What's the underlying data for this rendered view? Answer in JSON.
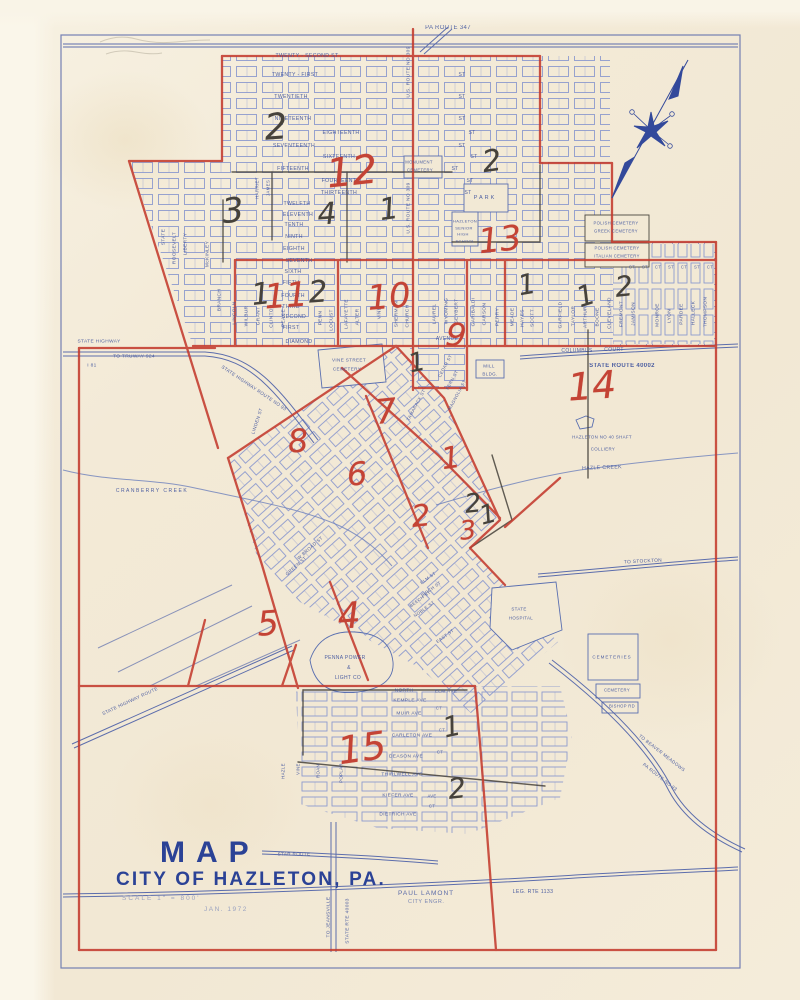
{
  "title_block": {
    "line1": "MAP",
    "line2": "CITY OF HAZLETON, PA.",
    "scale": "SCALE  1\" = 800'",
    "engineer": "PAUL LAMONT",
    "engineer_title": "CITY ENGR.",
    "date": "JAN. 1972"
  },
  "colors": {
    "paper": "#f2e9d5",
    "ink_blue": "#4c60a8",
    "block_blue": "#8d9ace",
    "ink_red": "#c43b2e",
    "pencil_black": "#46423b"
  },
  "ward_numbers": [
    {
      "t": "2",
      "c": "black",
      "x": 276,
      "y": 128,
      "s": 36,
      "r": -4
    },
    {
      "t": "12",
      "c": "red",
      "x": 352,
      "y": 172,
      "s": 40,
      "r": -6
    },
    {
      "t": "2",
      "c": "black",
      "x": 492,
      "y": 162,
      "s": 30,
      "r": -8
    },
    {
      "t": "3",
      "c": "black",
      "x": 233,
      "y": 211,
      "s": 34,
      "r": -6
    },
    {
      "t": "4",
      "c": "black",
      "x": 327,
      "y": 215,
      "s": 30,
      "r": -4
    },
    {
      "t": "1",
      "c": "black",
      "x": 389,
      "y": 210,
      "s": 30,
      "r": -8
    },
    {
      "t": "13",
      "c": "red",
      "x": 500,
      "y": 240,
      "s": 34,
      "r": -6
    },
    {
      "t": "1",
      "c": "black",
      "x": 261,
      "y": 295,
      "s": 30,
      "r": -6
    },
    {
      "t": "11",
      "c": "red",
      "x": 286,
      "y": 296,
      "s": 34,
      "r": -4
    },
    {
      "t": "2",
      "c": "black",
      "x": 318,
      "y": 293,
      "s": 30,
      "r": -4
    },
    {
      "t": "10",
      "c": "red",
      "x": 389,
      "y": 297,
      "s": 34,
      "r": -5
    },
    {
      "t": "1",
      "c": "black",
      "x": 527,
      "y": 285,
      "s": 28,
      "r": -10
    },
    {
      "t": "1",
      "c": "black",
      "x": 586,
      "y": 296,
      "s": 28,
      "r": -18
    },
    {
      "t": "2",
      "c": "black",
      "x": 624,
      "y": 287,
      "s": 28,
      "r": -6
    },
    {
      "t": "9",
      "c": "red",
      "x": 456,
      "y": 335,
      "s": 32,
      "r": 6
    },
    {
      "t": "1",
      "c": "black",
      "x": 417,
      "y": 363,
      "s": 26,
      "r": -12
    },
    {
      "t": "14",
      "c": "red",
      "x": 592,
      "y": 386,
      "s": 38,
      "r": -4
    },
    {
      "t": "7",
      "c": "red",
      "x": 386,
      "y": 412,
      "s": 34,
      "r": -6
    },
    {
      "t": "8",
      "c": "red",
      "x": 298,
      "y": 441,
      "s": 32,
      "r": -4
    },
    {
      "t": "1",
      "c": "red",
      "x": 451,
      "y": 459,
      "s": 30,
      "r": -8
    },
    {
      "t": "6",
      "c": "red",
      "x": 357,
      "y": 474,
      "s": 32,
      "r": -4
    },
    {
      "t": "2",
      "c": "black",
      "x": 473,
      "y": 504,
      "s": 26,
      "r": -6
    },
    {
      "t": "1",
      "c": "black",
      "x": 488,
      "y": 515,
      "s": 26,
      "r": -15
    },
    {
      "t": "2",
      "c": "red",
      "x": 421,
      "y": 517,
      "s": 30,
      "r": -6
    },
    {
      "t": "3",
      "c": "red",
      "x": 468,
      "y": 531,
      "s": 26,
      "r": -6
    },
    {
      "t": "5",
      "c": "red",
      "x": 268,
      "y": 624,
      "s": 34,
      "r": -4
    },
    {
      "t": "4",
      "c": "red",
      "x": 349,
      "y": 617,
      "s": 36,
      "r": -4
    },
    {
      "t": "15",
      "c": "red",
      "x": 362,
      "y": 748,
      "s": 38,
      "r": -8
    },
    {
      "t": "1",
      "c": "black",
      "x": 452,
      "y": 727,
      "s": 28,
      "r": -12
    },
    {
      "t": "2",
      "c": "black",
      "x": 457,
      "y": 789,
      "s": 28,
      "r": -6
    }
  ],
  "map_labels": [
    {
      "t": "PA ROUTE 347",
      "x": 448,
      "y": 28,
      "s": 6
    },
    {
      "t": "U.S. ROUTE NO 309",
      "x": 409,
      "y": 72,
      "s": 4.8,
      "r": -90
    },
    {
      "t": "U.S. ROUTE NO 309",
      "x": 409,
      "y": 208,
      "s": 4.8,
      "r": -90
    },
    {
      "t": "TWENTY - SECOND ST",
      "x": 307,
      "y": 56,
      "s": 5.2
    },
    {
      "t": "TWENTY - FIRST",
      "x": 295,
      "y": 75,
      "s": 5.2
    },
    {
      "t": "ST",
      "x": 462,
      "y": 75,
      "s": 5
    },
    {
      "t": "TWENTIETH",
      "x": 291,
      "y": 97,
      "s": 5.2
    },
    {
      "t": "ST",
      "x": 462,
      "y": 97,
      "s": 5
    },
    {
      "t": "NINETEENTH",
      "x": 293,
      "y": 119,
      "s": 5.2
    },
    {
      "t": "ST",
      "x": 462,
      "y": 119,
      "s": 5
    },
    {
      "t": "EIGHTEENTH",
      "x": 341,
      "y": 133,
      "s": 5.2
    },
    {
      "t": "ST",
      "x": 472,
      "y": 133,
      "s": 5
    },
    {
      "t": "SEVENTEENTH",
      "x": 294,
      "y": 146,
      "s": 5.2
    },
    {
      "t": "ST",
      "x": 462,
      "y": 146,
      "s": 5
    },
    {
      "t": "SIXTEENTH",
      "x": 339,
      "y": 157,
      "s": 5.2
    },
    {
      "t": "ST",
      "x": 474,
      "y": 157,
      "s": 5
    },
    {
      "t": "FIFTEENTH",
      "x": 293,
      "y": 169,
      "s": 5.2
    },
    {
      "t": "ST",
      "x": 455,
      "y": 169,
      "s": 5
    },
    {
      "t": "FOURTEENTH",
      "x": 341,
      "y": 181,
      "s": 5.2
    },
    {
      "t": "ST",
      "x": 470,
      "y": 181,
      "s": 5
    },
    {
      "t": "THIRTEENTH",
      "x": 339,
      "y": 193,
      "s": 5.2
    },
    {
      "t": "ST",
      "x": 468,
      "y": 193,
      "s": 5
    },
    {
      "t": "TWELFTH",
      "x": 297,
      "y": 204,
      "s": 5.2
    },
    {
      "t": "ELEVENTH",
      "x": 298,
      "y": 215,
      "s": 5.2
    },
    {
      "t": "TENTH",
      "x": 294,
      "y": 225,
      "s": 5.2
    },
    {
      "t": "NINTH",
      "x": 294,
      "y": 237,
      "s": 5.2
    },
    {
      "t": "EIGHTH",
      "x": 294,
      "y": 249,
      "s": 5.2
    },
    {
      "t": "SEVENTH",
      "x": 299,
      "y": 261,
      "s": 5.2
    },
    {
      "t": "SIXTH",
      "x": 293,
      "y": 272,
      "s": 5.2
    },
    {
      "t": "FIFTH",
      "x": 291,
      "y": 283,
      "s": 5.2
    },
    {
      "t": "FOURTH",
      "x": 293,
      "y": 296,
      "s": 5.2
    },
    {
      "t": "THIRD",
      "x": 291,
      "y": 307,
      "s": 5.2
    },
    {
      "t": "SECOND",
      "x": 294,
      "y": 317,
      "s": 5.2
    },
    {
      "t": "FIRST",
      "x": 291,
      "y": 328,
      "s": 5.2
    },
    {
      "t": "DIAMOND",
      "x": 299,
      "y": 342,
      "s": 5.2
    },
    {
      "t": "CT",
      "x": 632,
      "y": 267,
      "s": 4.2
    },
    {
      "t": "ST",
      "x": 645,
      "y": 267,
      "s": 4.2
    },
    {
      "t": "CT",
      "x": 658,
      "y": 267,
      "s": 4.2
    },
    {
      "t": "ST",
      "x": 671,
      "y": 267,
      "s": 4.2
    },
    {
      "t": "CT",
      "x": 684,
      "y": 267,
      "s": 4.2
    },
    {
      "t": "ST",
      "x": 697,
      "y": 267,
      "s": 4.2
    },
    {
      "t": "CT",
      "x": 710,
      "y": 267,
      "s": 4.2
    },
    {
      "t": "STATE",
      "x": 164,
      "y": 237,
      "s": 4.8,
      "r": -90
    },
    {
      "t": "ROOSEVELT",
      "x": 175,
      "y": 248,
      "s": 4.8,
      "r": -90
    },
    {
      "t": "LIBERTY",
      "x": 186,
      "y": 244,
      "s": 4.8,
      "r": -90
    },
    {
      "t": "McKINLEY",
      "x": 208,
      "y": 254,
      "s": 4.8,
      "r": -90
    },
    {
      "t": "BRANCH",
      "x": 220,
      "y": 300,
      "s": 4.8,
      "r": -90
    },
    {
      "t": "HARRIET",
      "x": 257,
      "y": 188,
      "s": 4.4,
      "r": -90
    },
    {
      "t": "JAMES",
      "x": 268,
      "y": 188,
      "s": 4.4,
      "r": -90
    },
    {
      "t": "LINCOLN",
      "x": 235,
      "y": 313,
      "s": 4.8,
      "r": -90
    },
    {
      "t": "WILBUR",
      "x": 247,
      "y": 316,
      "s": 4.8,
      "r": -90
    },
    {
      "t": "GRANT",
      "x": 259,
      "y": 316,
      "s": 4.8,
      "r": -90
    },
    {
      "t": "CLINTON",
      "x": 272,
      "y": 316,
      "s": 4.8,
      "r": -90
    },
    {
      "t": "PEACE",
      "x": 284,
      "y": 318,
      "s": 4.8,
      "r": -90
    },
    {
      "t": "PENN",
      "x": 321,
      "y": 318,
      "s": 4.8,
      "r": -90
    },
    {
      "t": "LOCUST",
      "x": 332,
      "y": 320,
      "s": 4.8,
      "r": -90
    },
    {
      "t": "LAFAYETTE",
      "x": 347,
      "y": 314,
      "s": 4.8,
      "r": -90
    },
    {
      "t": "ALTER",
      "x": 358,
      "y": 317,
      "s": 4.8,
      "r": -90
    },
    {
      "t": "VINE",
      "x": 380,
      "y": 313,
      "s": 4.8,
      "r": -90
    },
    {
      "t": "SHERMAN",
      "x": 397,
      "y": 314,
      "s": 4.8,
      "r": -90
    },
    {
      "t": "CHURCH",
      "x": 408,
      "y": 316,
      "s": 4.8,
      "r": -90
    },
    {
      "t": "LAUREL",
      "x": 435,
      "y": 314,
      "s": 4.8,
      "r": -90
    },
    {
      "t": "WYOMING",
      "x": 447,
      "y": 311,
      "s": 4.8,
      "r": -90
    },
    {
      "t": "SEYBERT",
      "x": 457,
      "y": 311,
      "s": 4.8,
      "r": -90
    },
    {
      "t": "GARIBALDI",
      "x": 474,
      "y": 312,
      "s": 4.8,
      "r": -90
    },
    {
      "t": "CARSON",
      "x": 485,
      "y": 314,
      "s": 4.8,
      "r": -90
    },
    {
      "t": "PERRY",
      "x": 498,
      "y": 317,
      "s": 4.8,
      "r": -90
    },
    {
      "t": "MEADE",
      "x": 513,
      "y": 317,
      "s": 4.8,
      "r": -90
    },
    {
      "t": "HAYES",
      "x": 523,
      "y": 318,
      "s": 4.8,
      "r": -90
    },
    {
      "t": "SCOTT",
      "x": 533,
      "y": 318,
      "s": 4.8,
      "r": -90
    },
    {
      "t": "GARFIELD",
      "x": 561,
      "y": 315,
      "s": 4.8,
      "r": -90
    },
    {
      "t": "TAYLOR",
      "x": 574,
      "y": 316,
      "s": 4.8,
      "r": -90
    },
    {
      "t": "ARTHUR",
      "x": 586,
      "y": 317,
      "s": 4.8,
      "r": -90
    },
    {
      "t": "BOONE",
      "x": 598,
      "y": 317,
      "s": 4.8,
      "r": -90
    },
    {
      "t": "CLEVELAND",
      "x": 610,
      "y": 313,
      "s": 4.8,
      "r": -90
    },
    {
      "t": "FREMONT",
      "x": 622,
      "y": 314,
      "s": 4.8,
      "r": -90
    },
    {
      "t": "JAMISON",
      "x": 634,
      "y": 314,
      "s": 4.8,
      "r": -90
    },
    {
      "t": "MONROE",
      "x": 658,
      "y": 315,
      "s": 4.8,
      "r": -90
    },
    {
      "t": "LYON",
      "x": 670,
      "y": 316,
      "s": 4.8,
      "r": -90
    },
    {
      "t": "PARDEE",
      "x": 682,
      "y": 314,
      "s": 4.8,
      "r": -90
    },
    {
      "t": "HALLECK",
      "x": 694,
      "y": 313,
      "s": 4.8,
      "r": -90
    },
    {
      "t": "THOMPSON",
      "x": 706,
      "y": 312,
      "s": 4.8,
      "r": -90
    },
    {
      "t": "MONUMENT",
      "x": 419,
      "y": 162,
      "s": 4.2
    },
    {
      "t": "CEMETERY",
      "x": 420,
      "y": 170,
      "s": 4.2
    },
    {
      "t": "PARK",
      "x": 485,
      "y": 198,
      "s": 5.5,
      "ls": 2
    },
    {
      "t": "HAZLETON",
      "x": 465,
      "y": 221,
      "s": 4
    },
    {
      "t": "SENIOR",
      "x": 464,
      "y": 228,
      "s": 4
    },
    {
      "t": "HIGH",
      "x": 463,
      "y": 234,
      "s": 4
    },
    {
      "t": "SCHOOL",
      "x": 465,
      "y": 241,
      "s": 4
    },
    {
      "t": "POLISH CEMETERY",
      "x": 616,
      "y": 223,
      "s": 4.2
    },
    {
      "t": "GREEK CEMETERY",
      "x": 616,
      "y": 231,
      "s": 4.2
    },
    {
      "t": "POLISH CEMETERY",
      "x": 617,
      "y": 248,
      "s": 4.2
    },
    {
      "t": "ITALIAN CEMETERY",
      "x": 617,
      "y": 256,
      "s": 4.2
    },
    {
      "t": "AVENUE",
      "x": 447,
      "y": 339,
      "s": 5
    },
    {
      "t": "VINE STREET",
      "x": 349,
      "y": 360,
      "s": 4.6
    },
    {
      "t": "CEMETERY",
      "x": 347,
      "y": 369,
      "s": 4.6
    },
    {
      "t": "MILL",
      "x": 489,
      "y": 366,
      "s": 4.5
    },
    {
      "t": "BLDG.",
      "x": 490,
      "y": 374,
      "s": 4.5
    },
    {
      "t": "COLUMBUS",
      "x": 577,
      "y": 351,
      "s": 5
    },
    {
      "t": "COURT",
      "x": 614,
      "y": 350,
      "s": 5
    },
    {
      "t": "STATE ROUTE 40002",
      "x": 622,
      "y": 366,
      "s": 6,
      "fw": 700
    },
    {
      "t": "HAZLETON NO 40 SHAFT",
      "x": 602,
      "y": 437,
      "s": 4.4
    },
    {
      "t": "COLLIERY",
      "x": 603,
      "y": 449,
      "s": 4.4
    },
    {
      "t": "HAZLE CREEK",
      "x": 602,
      "y": 468,
      "s": 5.2,
      "r": -2
    },
    {
      "t": "CRANBERRY CREEK",
      "x": 152,
      "y": 491,
      "s": 5,
      "ls": 1.5
    },
    {
      "t": "STATE HIGHWAY",
      "x": 99,
      "y": 342,
      "s": 4.8
    },
    {
      "t": "TO   TRUWAY 924",
      "x": 134,
      "y": 357,
      "s": 4.8
    },
    {
      "t": "I 81",
      "x": 92,
      "y": 366,
      "s": 4.8
    },
    {
      "t": "STATE HIGHWAY ROUTE NO 93",
      "x": 254,
      "y": 388,
      "s": 4.6,
      "r": 34
    },
    {
      "t": "LINDEN ST",
      "x": 257,
      "y": 421,
      "s": 4.6,
      "r": -72
    },
    {
      "t": "STATE",
      "x": 519,
      "y": 609,
      "s": 4.4
    },
    {
      "t": "HOSPITAL",
      "x": 521,
      "y": 618,
      "s": 4.4
    },
    {
      "t": "TO STOCKTON",
      "x": 643,
      "y": 562,
      "s": 4.8,
      "r": -3
    },
    {
      "t": "CEMETERIES",
      "x": 612,
      "y": 657,
      "s": 4.5,
      "ls": 1
    },
    {
      "t": "CEMETERY",
      "x": 617,
      "y": 690,
      "s": 4.2
    },
    {
      "t": "BISHOP RD",
      "x": 622,
      "y": 706,
      "s": 4.2
    },
    {
      "t": "TO BEAVER MEADOWS",
      "x": 662,
      "y": 753,
      "s": 4.6,
      "r": 38
    },
    {
      "t": "PA ROUTE NO 93",
      "x": 660,
      "y": 777,
      "s": 4.6,
      "r": 38
    },
    {
      "t": "LEG. RTE 1133",
      "x": 533,
      "y": 892,
      "s": 5.2
    },
    {
      "t": "STAR ROUTE",
      "x": 294,
      "y": 854,
      "s": 4.6
    },
    {
      "t": "TO JEANSVILLE",
      "x": 329,
      "y": 917,
      "s": 4.8,
      "r": -90
    },
    {
      "t": "STATE RTE 40003",
      "x": 348,
      "y": 921,
      "s": 4.8,
      "r": -90
    },
    {
      "t": "STATE HIGHWAY ROUTE",
      "x": 130,
      "y": 701,
      "s": 4.6,
      "r": -25
    },
    {
      "t": "PENNA POWER",
      "x": 345,
      "y": 658,
      "s": 5
    },
    {
      "t": "&",
      "x": 349,
      "y": 668,
      "s": 5
    },
    {
      "t": "LIGHT CO",
      "x": 348,
      "y": 678,
      "s": 5
    },
    {
      "t": "W BROAD ST",
      "x": 310,
      "y": 548,
      "s": 4.6,
      "r": -42
    },
    {
      "t": "GREEN ST",
      "x": 296,
      "y": 566,
      "s": 4.6,
      "r": -42
    },
    {
      "t": "CEDAR ST",
      "x": 445,
      "y": 366,
      "s": 4.4,
      "r": -62
    },
    {
      "t": "FERN ST",
      "x": 452,
      "y": 380,
      "s": 4.4,
      "r": -62
    },
    {
      "t": "MAGNOLIA ST",
      "x": 457,
      "y": 395,
      "s": 4.4,
      "r": -62
    },
    {
      "t": "TAMARACK ST",
      "x": 416,
      "y": 405,
      "s": 4.4,
      "r": -62
    },
    {
      "t": "ELM ST",
      "x": 428,
      "y": 578,
      "s": 4.4,
      "r": -36
    },
    {
      "t": "BIRCH ST",
      "x": 431,
      "y": 589,
      "s": 4.4,
      "r": -36
    },
    {
      "t": "BEECH ST",
      "x": 420,
      "y": 599,
      "s": 4.4,
      "r": -36
    },
    {
      "t": "NOBLE ST",
      "x": 424,
      "y": 609,
      "s": 4.4,
      "r": -36
    },
    {
      "t": "EAST ST",
      "x": 445,
      "y": 636,
      "s": 4.4,
      "r": -36
    },
    {
      "t": "NORTH",
      "x": 404,
      "y": 691,
      "s": 4.8
    },
    {
      "t": "ELM AVE",
      "x": 446,
      "y": 692,
      "s": 4.8
    },
    {
      "t": "KEMPLE AVE",
      "x": 410,
      "y": 701,
      "s": 4.8
    },
    {
      "t": "MUIR AVE",
      "x": 409,
      "y": 714,
      "s": 4.8
    },
    {
      "t": "CT",
      "x": 439,
      "y": 708,
      "s": 4.2
    },
    {
      "t": "CARLETON AVE",
      "x": 412,
      "y": 736,
      "s": 4.8
    },
    {
      "t": "CT",
      "x": 442,
      "y": 730,
      "s": 4.2
    },
    {
      "t": "DEASON AVE",
      "x": 406,
      "y": 757,
      "s": 4.8
    },
    {
      "t": "CT",
      "x": 440,
      "y": 752,
      "s": 4.2
    },
    {
      "t": "THIRLWELL AVE",
      "x": 402,
      "y": 775,
      "s": 4.8
    },
    {
      "t": "KIEFER AVE",
      "x": 398,
      "y": 796,
      "s": 4.8
    },
    {
      "t": "AVE",
      "x": 432,
      "y": 796,
      "s": 4.2
    },
    {
      "t": "DIETRICH AVE",
      "x": 398,
      "y": 815,
      "s": 4.8
    },
    {
      "t": "CT",
      "x": 432,
      "y": 806,
      "s": 4.2
    },
    {
      "t": "VINE",
      "x": 298,
      "y": 769,
      "s": 4.4,
      "r": -90
    },
    {
      "t": "ROAN",
      "x": 318,
      "y": 771,
      "s": 4.4,
      "r": -90
    },
    {
      "t": "POPLAR",
      "x": 341,
      "y": 773,
      "s": 4.4,
      "r": -90
    },
    {
      "t": "HAZLE",
      "x": 283,
      "y": 771,
      "s": 4.4,
      "r": -90
    }
  ]
}
